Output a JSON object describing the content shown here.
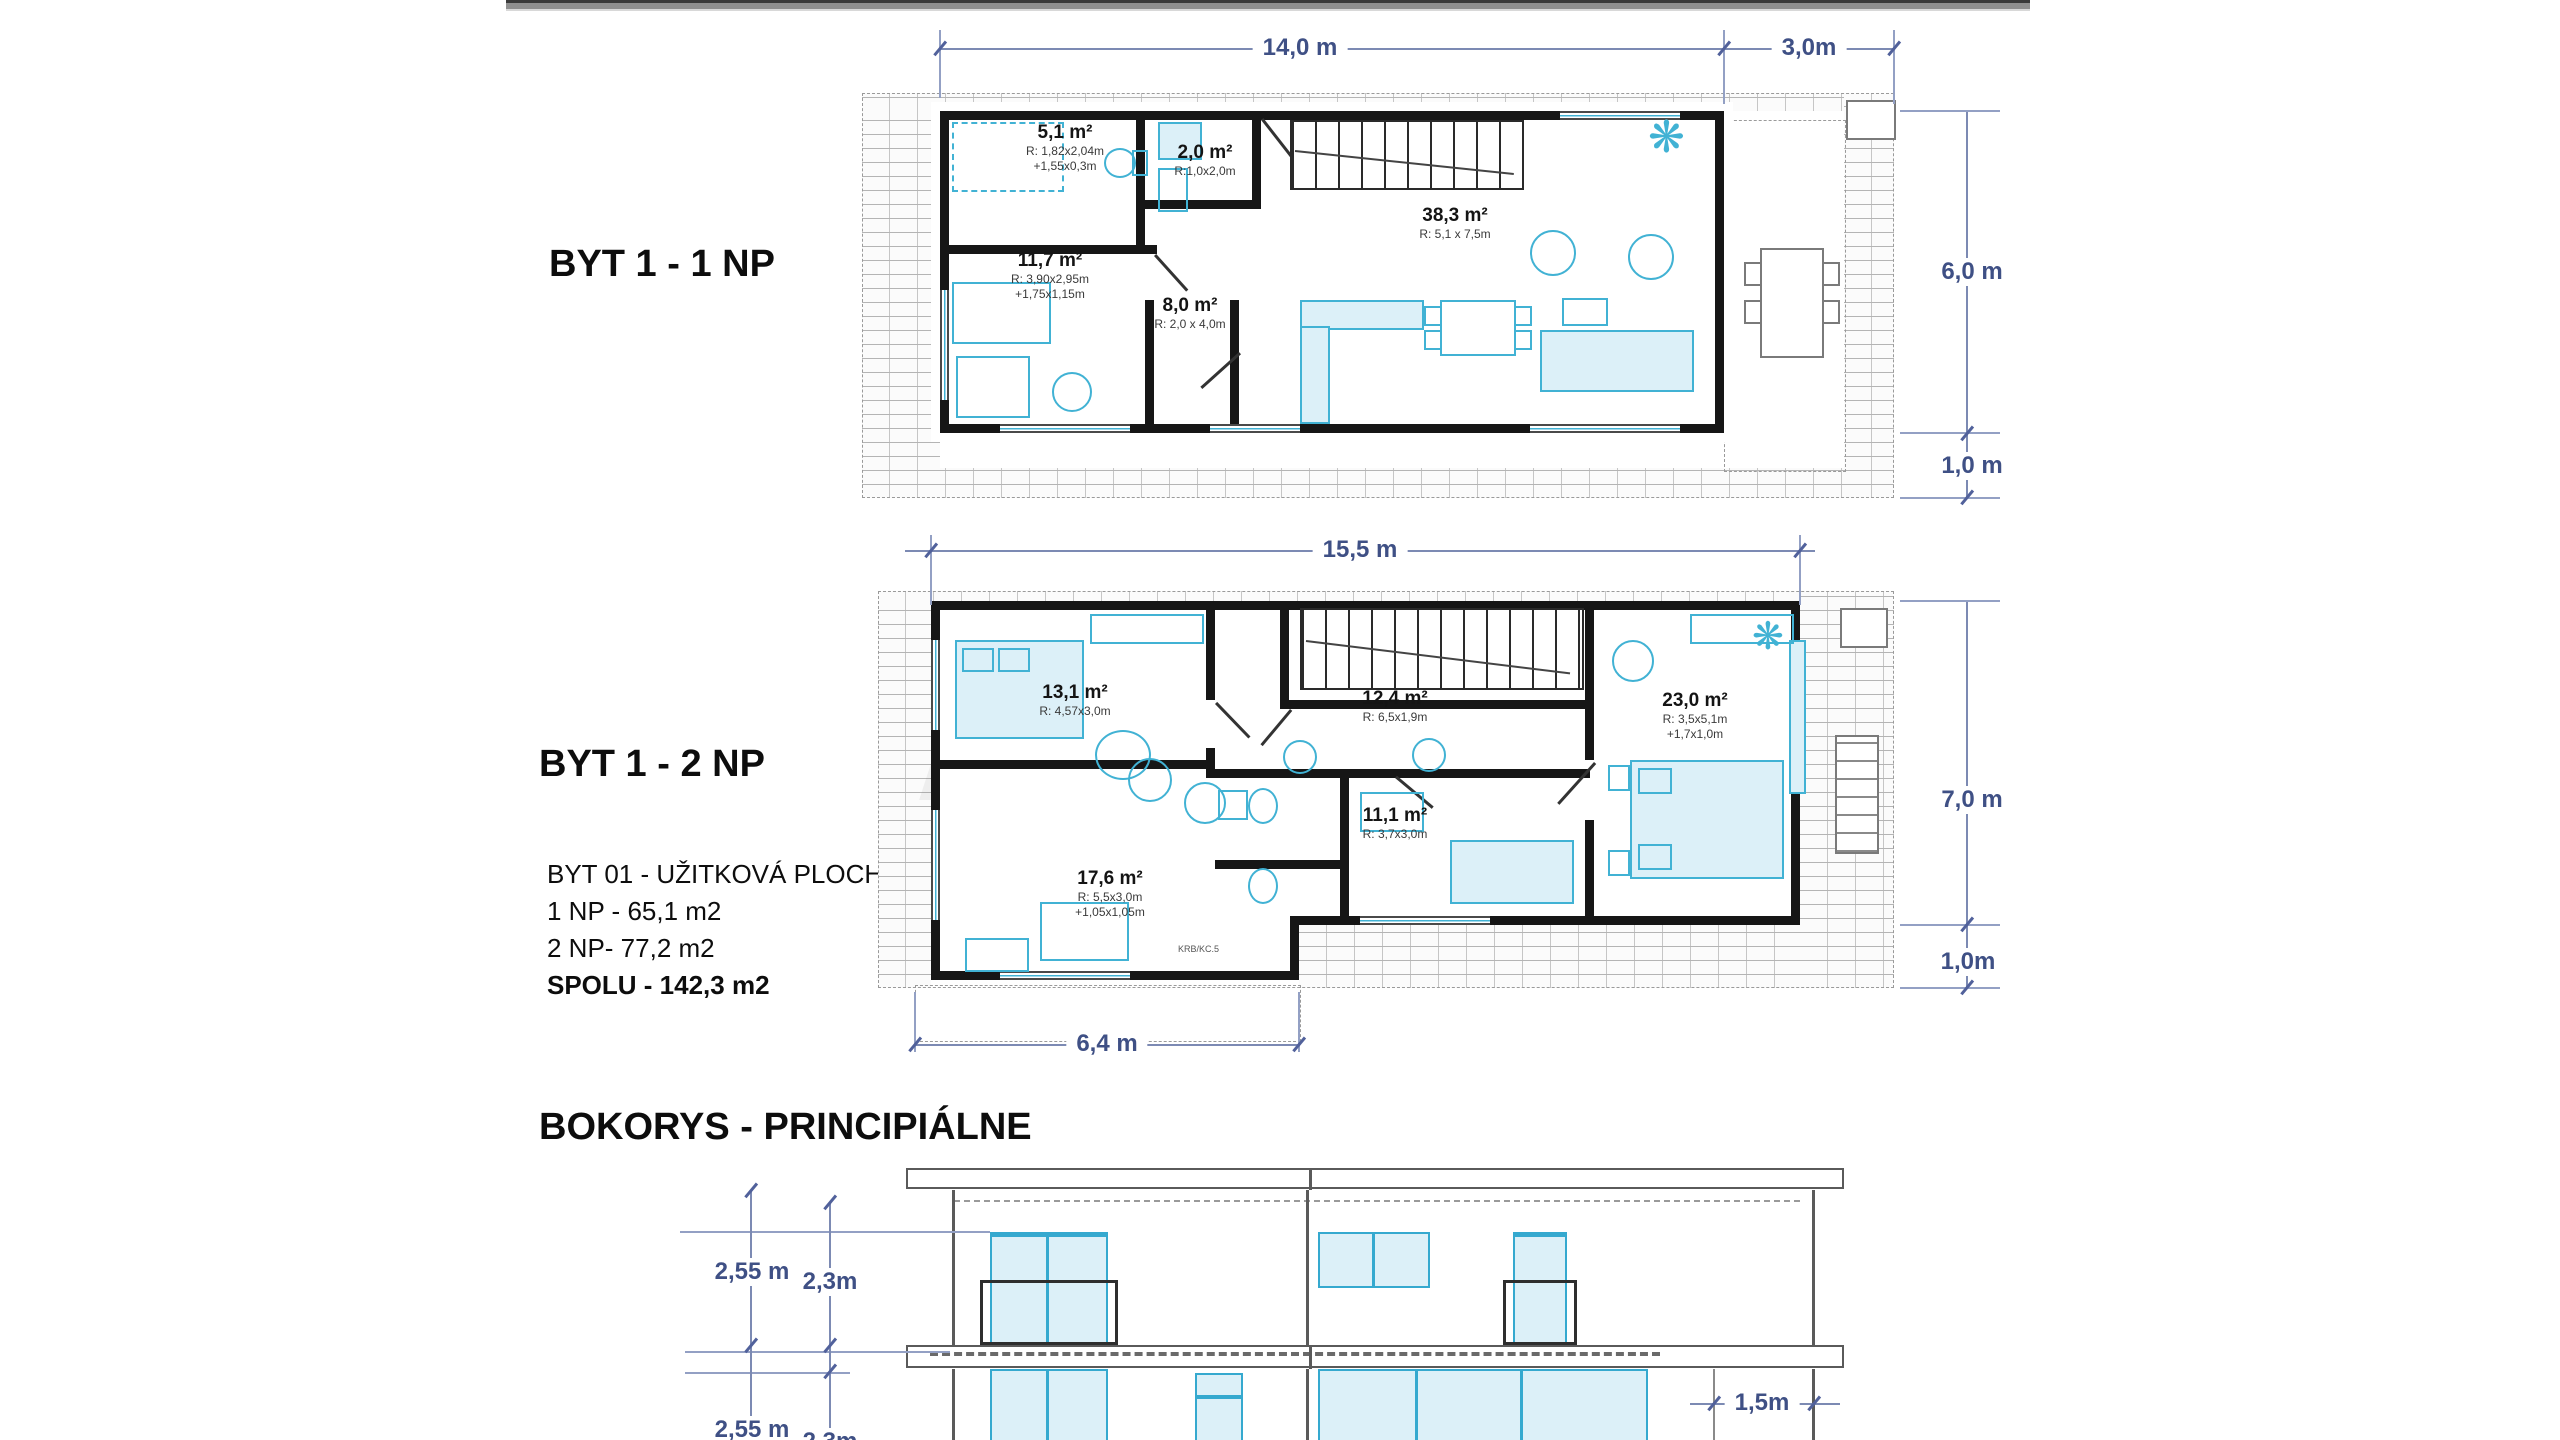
{
  "colors": {
    "dimension_blue": "#3f5085",
    "wall_black": "#161616",
    "furniture_cyan": "#41b2d4",
    "window_fill": "#dcf0f8",
    "hatch_gray": "#b4b4b4"
  },
  "icons": {
    "plant": "❋"
  },
  "plan1": {
    "title": "BYT 1 - 1 NP",
    "dims": {
      "top_main": "14,0 m",
      "top_right": "3,0m",
      "right": "6,0 m",
      "right_lower": "1,0 m"
    },
    "rooms": [
      {
        "area": "5,1 m²",
        "d1": "R: 1,82x2,04m",
        "d2": "+1,55x0,3m"
      },
      {
        "area": "2,0 m²",
        "d1": "R:1,0x2,0m"
      },
      {
        "area": "11,7 m²",
        "d1": "R: 3,90x2,95m",
        "d2": "+1,75x1,15m"
      },
      {
        "area": "8,0 m²",
        "d1": "R: 2,0 x 4,0m"
      },
      {
        "area": "38,3 m²",
        "d1": "R: 5,1 x 7,5m"
      }
    ]
  },
  "plan2": {
    "title": "BYT 1 - 2 NP",
    "info": [
      "BYT 01 - UŽITKOVÁ PLOCHA",
      "1 NP - 65,1 m2",
      "2 NP- 77,2 m2",
      "SPOLU - 142,3 m2"
    ],
    "dims": {
      "top": "15,5 m",
      "right": "7,0 m",
      "right_lower": "1,0m",
      "bottom": "6,4 m"
    },
    "rooms": [
      {
        "area": "13,1 m²",
        "d1": "R: 4,57x3,0m"
      },
      {
        "area": "12,4 m²",
        "d1": "R: 6,5x1,9m"
      },
      {
        "area": "23,0 m²",
        "d1": "R: 3,5x5,1m",
        "d2": "+1,7x1,0m"
      },
      {
        "area": "11,1 m²",
        "d1": "R: 3,7x3,0m"
      },
      {
        "area": "17,6 m²",
        "d1": "R: 5,5x3,0m",
        "d2": "+1,05x1,05m"
      }
    ],
    "fireplace_label": "KRB/KC.5"
  },
  "elevation": {
    "title": "BOKORYS - PRINCIPIÁLNE",
    "dims": {
      "upper_left_outer": "2,55 m",
      "upper_left_inner": "2,3m",
      "lower_left_outer": "2,55 m",
      "lower_left_inner": "2,3m",
      "right": "1,5m"
    }
  }
}
